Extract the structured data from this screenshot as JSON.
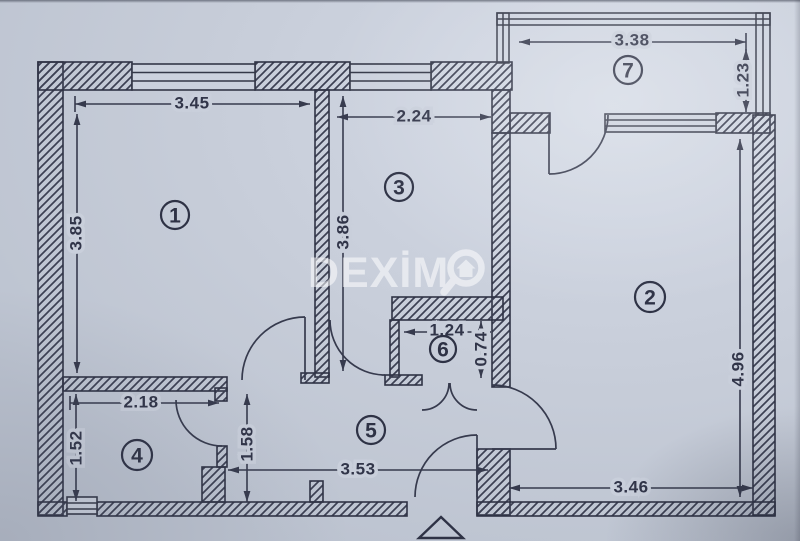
{
  "document": {
    "type": "apartment-floor-plan",
    "style": "scanned blueprint photo on blue-gray paper"
  },
  "colors": {
    "paper": "#c7cdda",
    "ink": "#363a4e",
    "watermark": "#ffffff"
  },
  "watermark": {
    "text": "DEXİM",
    "icon": "magnifier-house-icon",
    "brand": "DEXIMO"
  },
  "rooms": [
    {
      "number": "1",
      "width_m": "3.45",
      "height_m": "3.85"
    },
    {
      "number": "2",
      "height_m": "4.96",
      "bottom_width_m": "3.46"
    },
    {
      "number": "3",
      "width_m": "2.24",
      "height_m": "3.86"
    },
    {
      "number": "4",
      "width_m": "2.18",
      "height_m": "1.52"
    },
    {
      "number": "5",
      "width_m": "3.53",
      "left_height_m": "1.58"
    },
    {
      "number": "6",
      "width_m": "1.24",
      "height_m": "0.74"
    },
    {
      "number": "7",
      "width_m": "3.38",
      "height_m": "1.23"
    }
  ],
  "dimensions": [
    {
      "id": "room1-width",
      "value": "3.45",
      "orientation": "horizontal"
    },
    {
      "id": "room1-height",
      "value": "3.85",
      "orientation": "vertical"
    },
    {
      "id": "room3-width",
      "value": "2.24",
      "orientation": "horizontal"
    },
    {
      "id": "room3-height",
      "value": "3.86",
      "orientation": "vertical"
    },
    {
      "id": "room7-width",
      "value": "3.38",
      "orientation": "horizontal"
    },
    {
      "id": "room7-height",
      "value": "1.23",
      "orientation": "vertical"
    },
    {
      "id": "room2-height",
      "value": "4.96",
      "orientation": "vertical"
    },
    {
      "id": "room6-width",
      "value": "1.24",
      "orientation": "horizontal"
    },
    {
      "id": "room6-height",
      "value": "0.74",
      "orientation": "vertical"
    },
    {
      "id": "room4-width",
      "value": "2.18",
      "orientation": "horizontal"
    },
    {
      "id": "room4-height",
      "value": "1.52",
      "orientation": "vertical"
    },
    {
      "id": "hall-height",
      "value": "1.58",
      "orientation": "vertical"
    },
    {
      "id": "hall-width",
      "value": "3.53",
      "orientation": "horizontal"
    },
    {
      "id": "room2-bottom-width",
      "value": "3.46",
      "orientation": "horizontal"
    }
  ],
  "markers": {
    "entrance": "triangle pointing up at bottom center"
  }
}
